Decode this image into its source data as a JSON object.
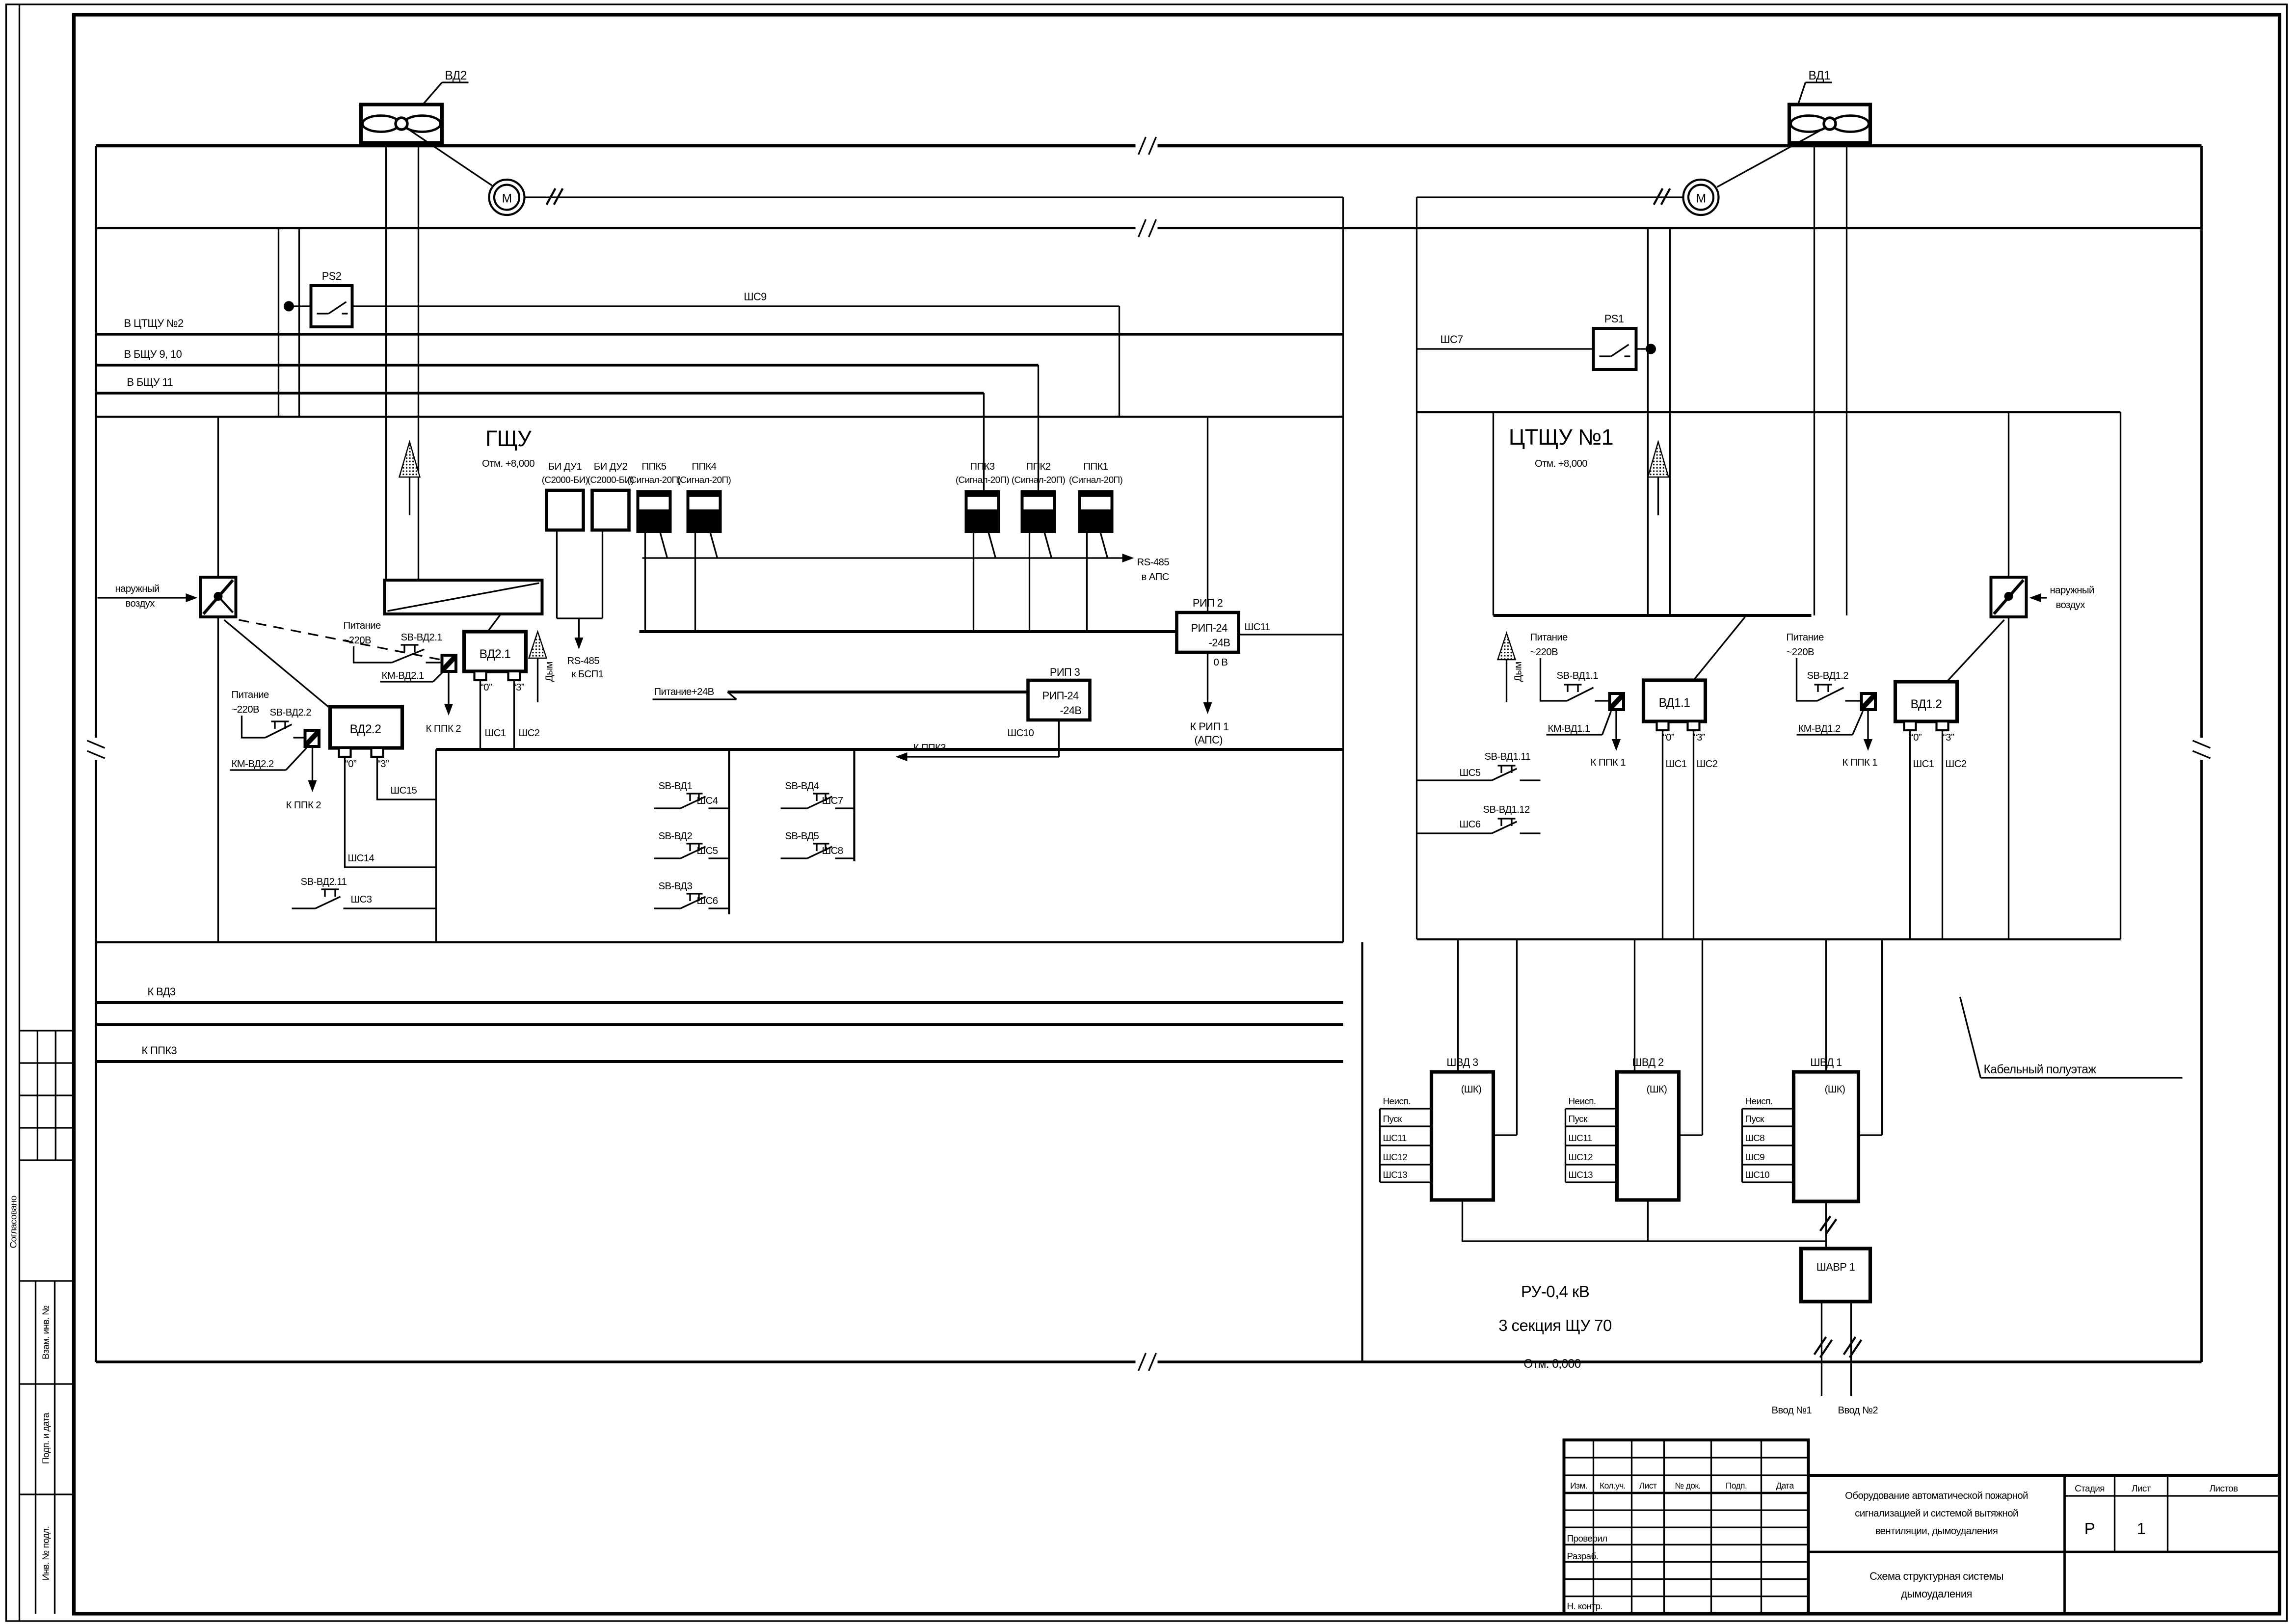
{
  "margin": {
    "soglasovano": "Согласовано",
    "vzam": "Взам. инв. №",
    "podp": "Подп. и дата",
    "inv": "Инв. № подл."
  },
  "fans": {
    "vd2": "ВД2",
    "vd1": "ВД1",
    "motor": "М"
  },
  "top_buses": {
    "b1": "В ЦТЩУ №2",
    "b2": "В БЩУ 9, 10",
    "b3": "В БЩУ 11"
  },
  "ps": {
    "ps2": "PS2",
    "ps1": "PS1",
    "shs9": "ШС9",
    "shs7": "ШС7"
  },
  "rooms": {
    "gshu": {
      "title": "ГЩУ",
      "elev": "Отм. +8,000"
    },
    "cshu": {
      "title": "ЦТЩУ №1",
      "elev": "Отм. +8,000"
    },
    "cable": {
      "label": "Кабельный полуэтаж"
    },
    "ru": {
      "l1": "РУ-0,4 кВ",
      "l2": "3 секция ЩУ 70",
      "l3": "Отм. 0,000"
    }
  },
  "blocks": [
    {
      "name": "БИ ДУ1",
      "type": "(С2000-БИ)"
    },
    {
      "name": "БИ ДУ2",
      "type": "(С2000-БИ)"
    },
    {
      "name": "ППК5",
      "type": "(Сигнал-20П)"
    },
    {
      "name": "ППК4",
      "type": "(Сигнал-20П)"
    },
    {
      "name": "ППК3",
      "type": "(Сигнал-20П)"
    },
    {
      "name": "ППК2",
      "type": "(Сигнал-20П)"
    },
    {
      "name": "ППК1",
      "type": "(Сигнал-20П)"
    }
  ],
  "rs485": {
    "aps1": "RS-485",
    "aps2": "в АПС",
    "bsp1": "RS-485",
    "bsp2": "к БСП1"
  },
  "power24": "Питание+24В",
  "rip2": {
    "title": "РИП 2",
    "l1": "РИП-24",
    "l2": "-24В",
    "shs11": "ШС11",
    "zero": "0 В",
    "to1": "К РИП 1",
    "to2": "(АПС)"
  },
  "rip3": {
    "title": "РИП 3",
    "l1": "РИП-24",
    "l2": "-24В",
    "shs10": "ШС10",
    "to": "К ППК3"
  },
  "vd21": {
    "p1": "Питание",
    "p2": "~220В",
    "sb": "SB-ВД2.1",
    "km": "КМ-ВД2.1",
    "box": "ВД2.1",
    "to": "К ППК 2",
    "t0": "“0”",
    "t3": "“3”",
    "s1": "ШС1",
    "s2": "ШС2",
    "smoke": "Дым"
  },
  "vd22": {
    "p1": "Питание",
    "p2": "~220В",
    "sb": "SB-ВД2.2",
    "km": "КМ-ВД2.2",
    "box": "ВД2.2",
    "to": "К ППК 2",
    "t0": "“0”",
    "t3": "“3”",
    "s15": "ШС15",
    "s14": "ШС14",
    "sb11": "SB-ВД2.11",
    "s3": "ШС3"
  },
  "vd11": {
    "p1": "Питание",
    "p2": "~220В",
    "sb": "SB-ВД1.1",
    "km": "КМ-ВД1.1",
    "box": "ВД1.1",
    "to": "К ППК 1",
    "t0": "“0”",
    "t3": "“3”",
    "s1": "ШС1",
    "s2": "ШС2",
    "smoke": "Дым"
  },
  "vd12": {
    "p1": "Питание",
    "p2": "~220В",
    "sb": "SB-ВД1.2",
    "km": "КМ-ВД1.2",
    "box": "ВД1.2",
    "to": "К ППК 1",
    "t0": "“0”",
    "t3": "“3”",
    "s1": "ШС1",
    "s2": "ШС2"
  },
  "sb_right": {
    "sb11": "SB-ВД1.11",
    "s5": "ШС5",
    "sb12": "SB-ВД1.12",
    "s6": "ШС6"
  },
  "sb_center": [
    {
      "sb": "SB-ВД1",
      "shs": "ШС4"
    },
    {
      "sb": "SB-ВД2",
      "shs": "ШС5"
    },
    {
      "sb": "SB-ВД3",
      "shs": "ШС6"
    },
    {
      "sb": "SB-ВД4",
      "shs": "ШС7"
    },
    {
      "sb": "SB-ВД5",
      "shs": "ШС8"
    }
  ],
  "air": {
    "l1": "наружный",
    "l2": "воздух"
  },
  "bottom_buses": {
    "b1": "К ВД3",
    "b2": "К ППК3"
  },
  "shvd": [
    {
      "title": "ШВД 3",
      "shk": "(ШК)",
      "rows": [
        "Неисп.",
        "Пуск",
        "ШС11",
        "ШС12",
        "ШС13"
      ]
    },
    {
      "title": "ШВД 2",
      "shk": "(ШК)",
      "rows": [
        "Неисп.",
        "Пуск",
        "ШС11",
        "ШС12",
        "ШС13"
      ]
    },
    {
      "title": "ШВД 1",
      "shk": "(ШК)",
      "rows": [
        "Неисп.",
        "Пуск",
        "ШС8",
        "ШС9",
        "ШС10"
      ]
    }
  ],
  "shavr": {
    "title": "ШАВР 1",
    "v1": "Ввод №1",
    "v2": "Ввод №2"
  },
  "titleblock": {
    "cols": [
      "Изм.",
      "Кол.уч.",
      "Лист",
      "№ док.",
      "Подп.",
      "Дата"
    ],
    "rows": [
      "Проверил",
      "Разраб.",
      "Н. контр."
    ],
    "doc": [
      "Оборудование автоматической пожарной",
      "сигнализацией и системой вытяжной",
      "вентиляции, дымоудаления"
    ],
    "scheme": [
      "Схема структурная системы",
      "дымоудаления"
    ],
    "stage_h": "Стадия",
    "sheet_h": "Лист",
    "sheets_h": "Листов",
    "stage": "Р",
    "sheet": "1"
  }
}
